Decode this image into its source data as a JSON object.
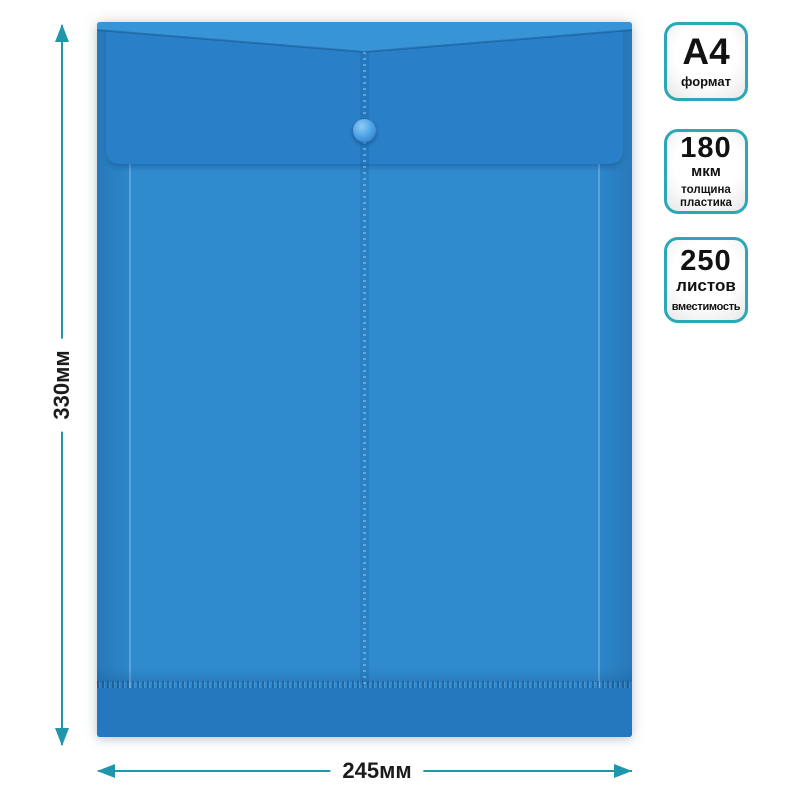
{
  "dimensions": {
    "height_label": "330мм",
    "width_label": "245мм"
  },
  "badges": [
    {
      "value": "А4",
      "caption": "формат"
    },
    {
      "value": "180",
      "unit": "мкм",
      "caption_line1": "толщина",
      "caption_line2": "пластика"
    },
    {
      "value": "250",
      "unit": "листов",
      "caption": "вместимость"
    }
  ],
  "colors": {
    "folder_body": "#2f8bce",
    "folder_flap": "#2a80c8",
    "folder_top": "#3794d7",
    "folder_bottom": "#2577be",
    "snap_button": "#4aa0e5",
    "badge_border": "#2ba7b7",
    "arrow": "#1f96ac",
    "label_text": "#1c1c1c"
  }
}
